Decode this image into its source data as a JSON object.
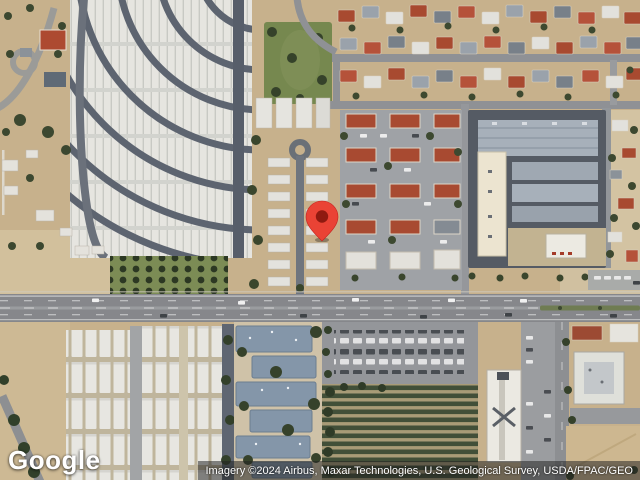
{
  "map": {
    "view_type": "satellite",
    "description": "Aerial satellite view of a desert suburb: curved mobile-home park at northwest, red-roofed residential blocks northeast, large industrial building east, a major east-west arterial road across the middle, trailer parks, apartment complex, plant-nursery rows and parking lots to the south",
    "marker": {
      "name": "red-location-pin",
      "color": "#EA4335",
      "dot_color": "#8F1A10",
      "style": "left:305px;top:200px;"
    },
    "palette": {
      "desert": "#c7b18c",
      "light_dirt": "#d9c9a9",
      "asphalt_road": "#86878b",
      "park_street": "#5d6470",
      "trailer_white": "#e6e5e0",
      "grass": "#7c8c55",
      "tree": "#36422b",
      "red_roof": "#a84a31",
      "apartment_roof": "#8496a9",
      "industrial_roof": "#a7b0ba",
      "cream_building": "#ece4d0"
    }
  },
  "branding": {
    "logo_text": "Google"
  },
  "attribution": {
    "text": "Imagery ©2024 Airbus, Maxar Technologies, U.S. Geological Survey, USDA/FPAC/GEO"
  }
}
